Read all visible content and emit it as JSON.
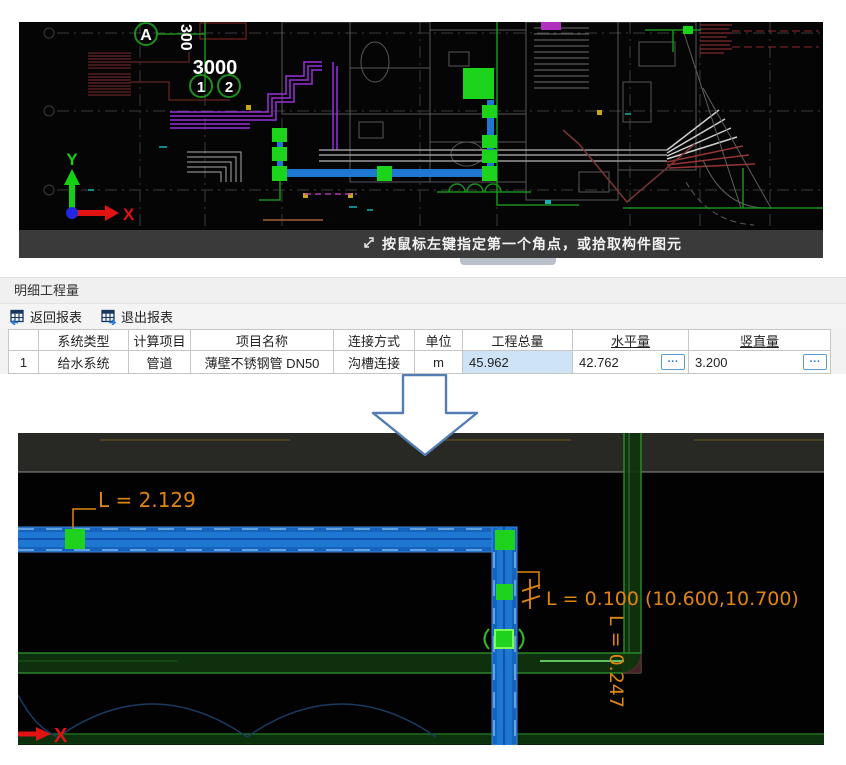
{
  "top_view": {
    "grid_labels": {
      "axis_a": "A",
      "bubble_1": "1",
      "bubble_2": "2",
      "dim_3000": "3000",
      "dim_300": "300"
    },
    "ucs": {
      "x": "X",
      "y": "Y"
    },
    "status_bar": {
      "icon": "pick-corner-icon",
      "text": "按鼠标左键指定第一个角点，或拾取构件图元"
    }
  },
  "panel": {
    "title": "明细工程量",
    "toolbar": [
      {
        "icon": "report-back-icon",
        "label": "返回报表"
      },
      {
        "icon": "report-exit-icon",
        "label": "退出报表"
      }
    ],
    "table": {
      "headers": [
        "",
        "系统类型",
        "计算项目",
        "项目名称",
        "连接方式",
        "单位",
        "工程总量",
        "水平量",
        "竖直量"
      ],
      "rows": [
        [
          "1",
          "给水系统",
          "管道",
          "薄壁不锈钢管 DN50",
          "沟槽连接",
          "m",
          "45.962",
          "42.762",
          "3.200"
        ]
      ],
      "detail_button": "···"
    }
  },
  "bottom_view": {
    "dims": {
      "horizontal": "L = 2.129",
      "riser_point": "L = 0.100 (10.600,10.700)",
      "vertical_run": "L = 0.247"
    },
    "ucs": {
      "x": "X"
    }
  },
  "colors": {
    "pipe_blue": "#1e78d2",
    "handle_green": "#1ed21e",
    "dim_orange": "#e08512",
    "wall_green": "#2e8f2e",
    "highlight_cell": "#cfe3f7",
    "accent_blue": "#5b9bd5",
    "status_bar_bg": "#3a3a3a",
    "arrow_outline": "#537db3"
  }
}
